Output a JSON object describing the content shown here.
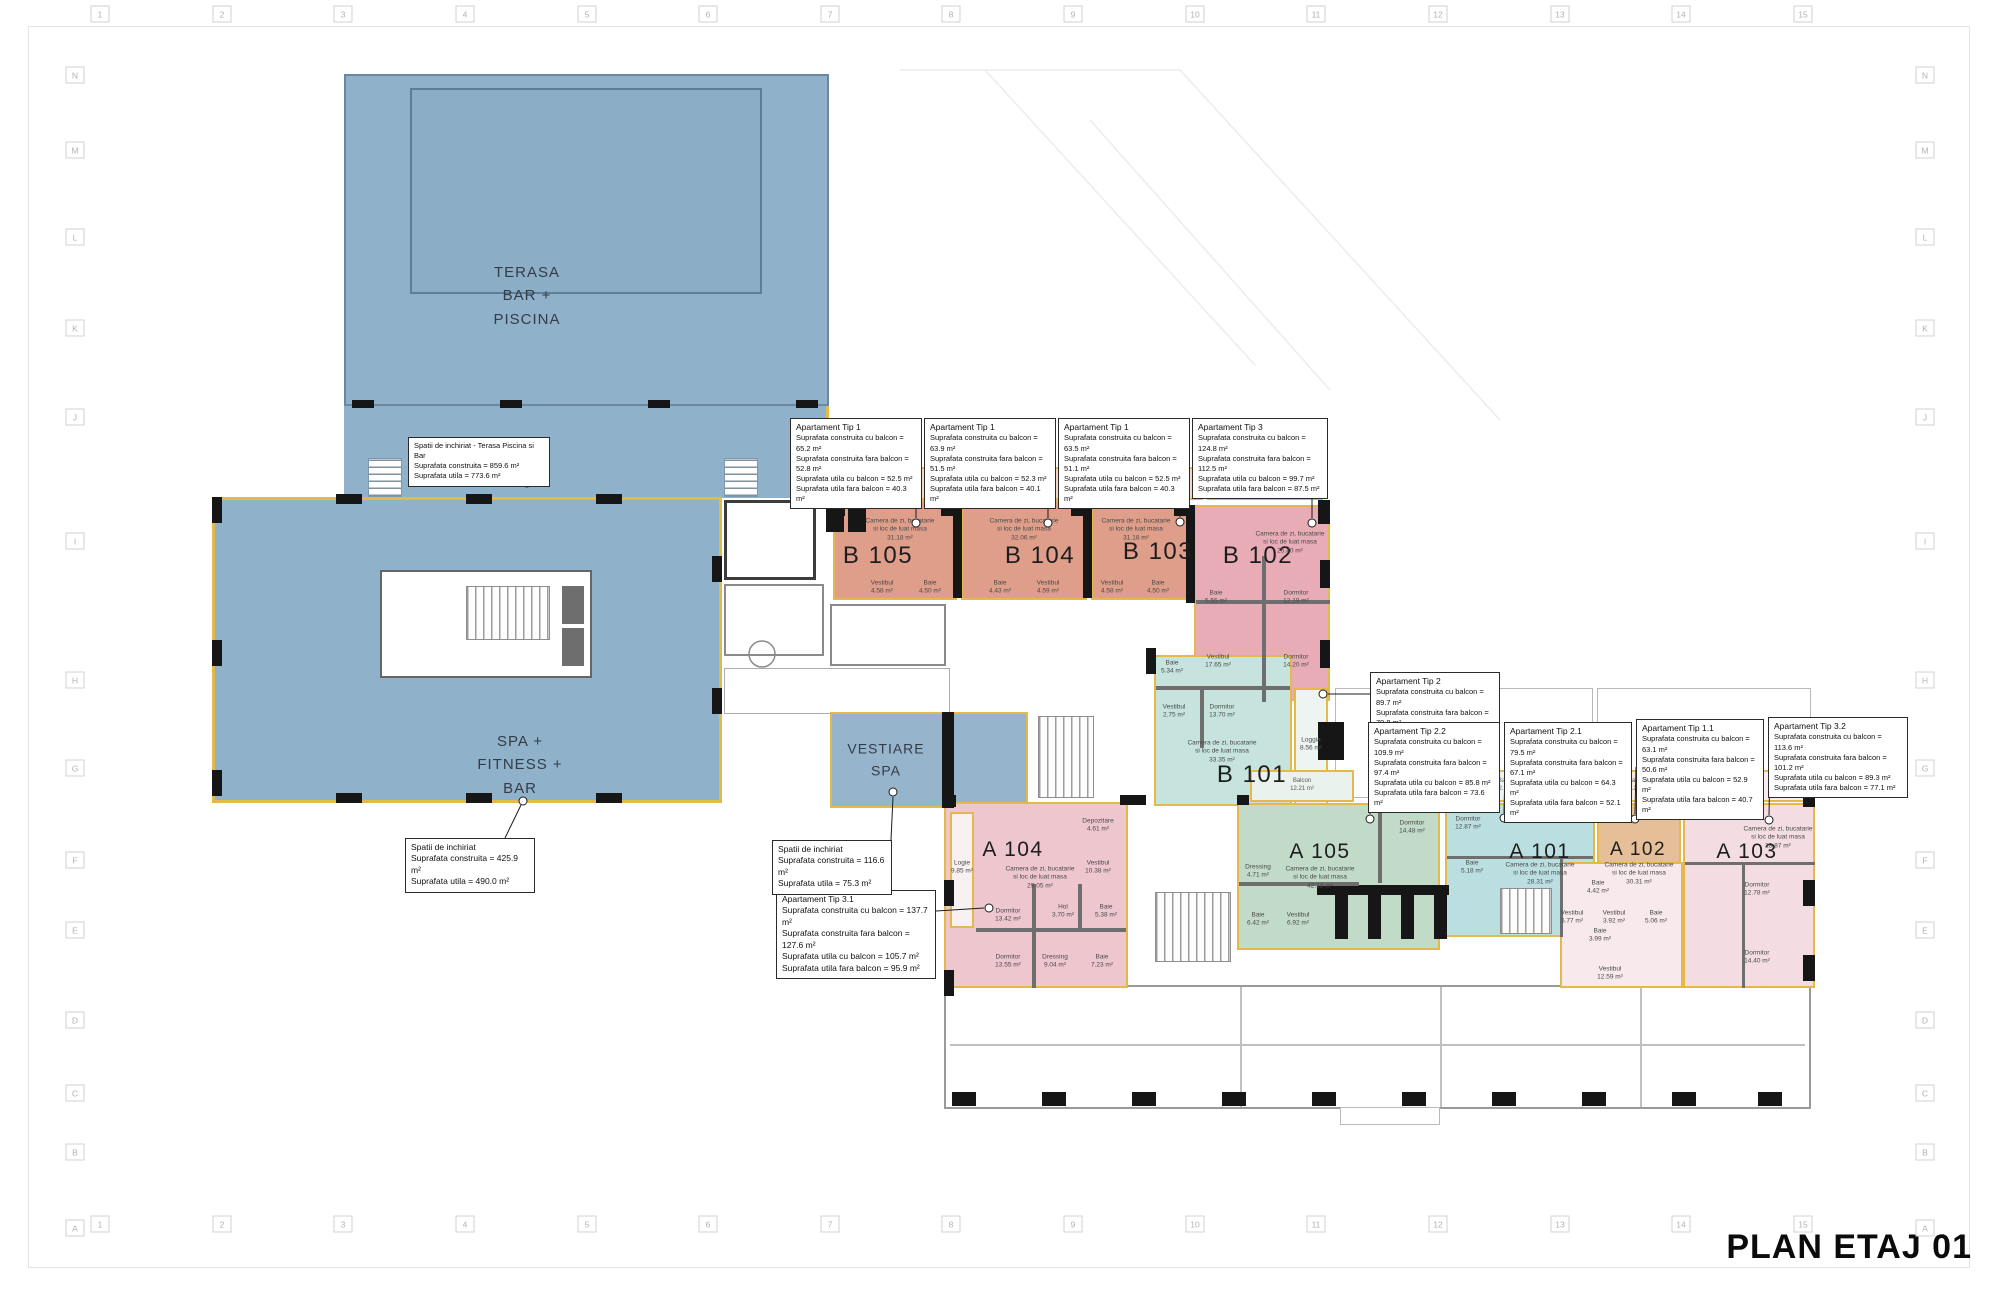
{
  "title": "PLAN ETAJ 01",
  "grid": {
    "columns": [
      "1",
      "2",
      "3",
      "4",
      "5",
      "6",
      "7",
      "8",
      "9",
      "10",
      "11",
      "12",
      "13",
      "14",
      "15"
    ],
    "rows": [
      "N",
      "M",
      "L",
      "K",
      "J",
      "I",
      "H",
      "G",
      "F",
      "E",
      "D",
      "C",
      "B",
      "A"
    ]
  },
  "zones": {
    "terasa": "TERASA\nBAR +\nPISCINA",
    "spa": "SPA +\nFITNESS +\nBAR",
    "vestiare": "VESTIARE\nSPA"
  },
  "notes": {
    "terasa_bar": {
      "body": "Spatii de inchiriat - Terasa Piscina si Bar\nSuprafata construita = 859.6 m²\nSuprafata utila = 773.6 m²"
    },
    "spa_fitness": {
      "body": "Spatii de inchiriat\nSuprafata construita = 425.9 m²\nSuprafata utila = 490.0 m²"
    },
    "vestiare_spa": {
      "body": "Spatii de inchiriat\nSuprafata construita = 116.6 m²\nSuprafata utila = 75.3 m²"
    },
    "tip1_a": {
      "title": "Apartament Tip 1",
      "body": "Suprafata construita cu balcon = 65.2 m²\nSuprafata construita fara balcon = 52.8 m²\nSuprafata utila cu balcon = 52.5 m²\nSuprafata utila fara balcon = 40.3 m²"
    },
    "tip1_b": {
      "title": "Apartament Tip 1",
      "body": "Suprafata construita cu balcon = 63.9 m²\nSuprafata construita fara balcon = 51.5 m²\nSuprafata utila cu balcon = 52.3 m²\nSuprafata utila fara balcon = 40.1 m²"
    },
    "tip1_c": {
      "title": "Apartament Tip 1",
      "body": "Suprafata construita cu balcon = 63.5 m²\nSuprafata construita fara balcon = 51.1 m²\nSuprafata utila cu balcon = 52.5 m²\nSuprafata utila fara balcon = 40.3 m²"
    },
    "tip3": {
      "title": "Apartament Tip 3",
      "body": "Suprafata construita cu balcon = 124.8 m²\nSuprafata construita fara balcon = 112.5 m²\nSuprafata utila cu balcon = 99.7 m²\nSuprafata utila fara balcon = 87.5 m²"
    },
    "tip2": {
      "title": "Apartament Tip 2",
      "body": "Suprafata construita cu balcon = 89.7 m²\nSuprafata construita fara balcon = 79.8 m²\nSuprafata utila cu balcon = 69.7 m²\nSuprafata utila fara balcon = 60.1 m²"
    },
    "tip2_2": {
      "title": "Apartament Tip 2.2",
      "body": "Suprafata construita cu balcon = 109.9 m²\nSuprafata construita fara balcon = 97.4 m²\nSuprafata utila cu balcon = 85.8 m²\nSuprafata utila fara balcon = 73.6 m²"
    },
    "tip2_1": {
      "title": "Apartament Tip 2.1",
      "body": "Suprafata construita cu balcon = 79.5 m²\nSuprafata construita fara balcon = 67.1 m²\nSuprafata utila cu balcon = 64.3 m²\nSuprafata utila fara balcon = 52.1 m²"
    },
    "tip1_1": {
      "title": "Apartament Tip 1.1",
      "body": "Suprafata construita cu balcon = 63.1 m²\nSuprafata construita fara balcon = 50.6 m²\nSuprafata utila cu balcon = 52.9 m²\nSuprafata utila fara balcon = 40.7 m²"
    },
    "tip3_2": {
      "title": "Apartament Tip 3.2",
      "body": "Suprafata construita cu balcon = 113.6 m²\nSuprafata construita fara balcon = 101.2 m²\nSuprafata utila cu balcon = 89.3 m²\nSuprafata utila fara balcon = 77.1 m²"
    },
    "tip3_1": {
      "title": "Apartament Tip 3.1",
      "body": "Suprafata construita cu balcon = 137.7 m²\nSuprafata construita fara balcon = 127.6 m²\nSuprafata utila cu balcon = 105.7 m²\nSuprafata utila fara balcon = 95.9 m²"
    }
  },
  "apartments": {
    "b105": {
      "code": "B 105",
      "camera": "Camera de zi, bucatarie\nsi loc de luat masa\n31.18 m²",
      "vestibul": "Vestibul\n4.58 m²",
      "baie": "Baie\n4.50 m²"
    },
    "b104": {
      "code": "B 104",
      "camera": "Camera de zi, bucatarie\nsi loc de luat masa\n32.06 m²",
      "vestibul": "Vestibul\n4.59 m²",
      "baie": "Baie\n4.43 m²"
    },
    "b103": {
      "code": "B 103",
      "camera": "Camera de zi, bucatarie\nsi loc de luat masa\n31.18 m²",
      "vestibul": "Vestibul\n4.58 m²",
      "baie": "Baie\n4.50 m²"
    },
    "b102": {
      "code": "B 102",
      "camera": "Camera de zi, bucatarie\nsi loc de luat masa\n25.40 m²",
      "baie": "Baie\n5.55 m²",
      "dormitor1": "Dormitor\n12.19 m²",
      "dormitor2": "Dormitor\n14.20 m²",
      "vestibul": "Vestibul\n17.65 m²"
    },
    "b101": {
      "code": "B 101",
      "camera": "Camera de zi, bucatarie\nsi loc de luat masa\n33.35 m²",
      "baie": "Baie\n5.34 m²",
      "vestibul": "Vestibul\n2.75 m²",
      "dormitor": "Dormitor\n13.70 m²",
      "loggia": "Loggia\n8.56 m²"
    },
    "a104": {
      "code": "A 104",
      "camera": "Camera de zi, bucatarie\nsi loc de luat masa\n29.05 m²",
      "loggia": "Logie\n9.85 m²",
      "depozitare": "Depozitare\n4.61 m²",
      "vestibul": "Vestibul\n10.38 m²",
      "hol": "Hol\n3.70 m²",
      "baie1": "Baie\n5.38 m²",
      "dormitor1": "Dormitor\n13.42 m²",
      "dormitor2": "Dormitor\n13.55 m²",
      "dressing": "Dressing\n9.04 m²",
      "baie2": "Baie\n7.23 m²"
    },
    "a105": {
      "code": "A 105",
      "camera": "Camera de zi, bucatarie\nsi loc de luat masa\n42.18 m²",
      "dormitor": "Dormitor\n14.48 m²",
      "dressing": "Dressing\n4.71 m²",
      "baie": "Baie\n6.42 m²",
      "vestibul": "Vestibul\n6.92 m²"
    },
    "a101": {
      "code": "A 101",
      "camera": "Camera de zi, bucatarie\nsi loc de luat masa\n28.31 m²",
      "dormitor": "Dormitor\n12.87 m²",
      "baie": "Baie\n5.18 m²",
      "vestibul": "Vestibul\n5.77 m²"
    },
    "a102": {
      "code": "A 102",
      "camera": "Camera de zi, bucatarie\nsi loc de luat masa\n30.31 m²",
      "vestibul": "Vestibul\n3.92 m²",
      "baie": "Baie\n5.06 m²"
    },
    "a103": {
      "code": "A 103",
      "camera": "Camera de zi, bucatarie\nsi loc de luat masa\n28.87 m²",
      "dormitor1": "Dormitor\n12.78 m²",
      "dormitor2": "Dormitor\n14.40 m²",
      "baie1": "Baie\n4.42 m²",
      "baie2": "Baie\n3.99 m²",
      "vestibul": "Vestibul\n12.59 m²"
    }
  },
  "balcon": {
    "plain": "Balcon",
    "with_area": "Balcon\n12.21 m²"
  },
  "colors": {
    "accent_gold": "#e4b84a",
    "terasa_blue": "#8fb1ca",
    "vestiare_blue": "#96b5cc",
    "salmon": "#df9e8a",
    "pink": "#e8acb6",
    "teal": "#c7e3de",
    "a_pink": "#eec6cd",
    "sage": "#c2dbc8",
    "cyan": "#bbdfe1",
    "tan": "#e5bf98",
    "pale_pink": "#f3dde2"
  }
}
